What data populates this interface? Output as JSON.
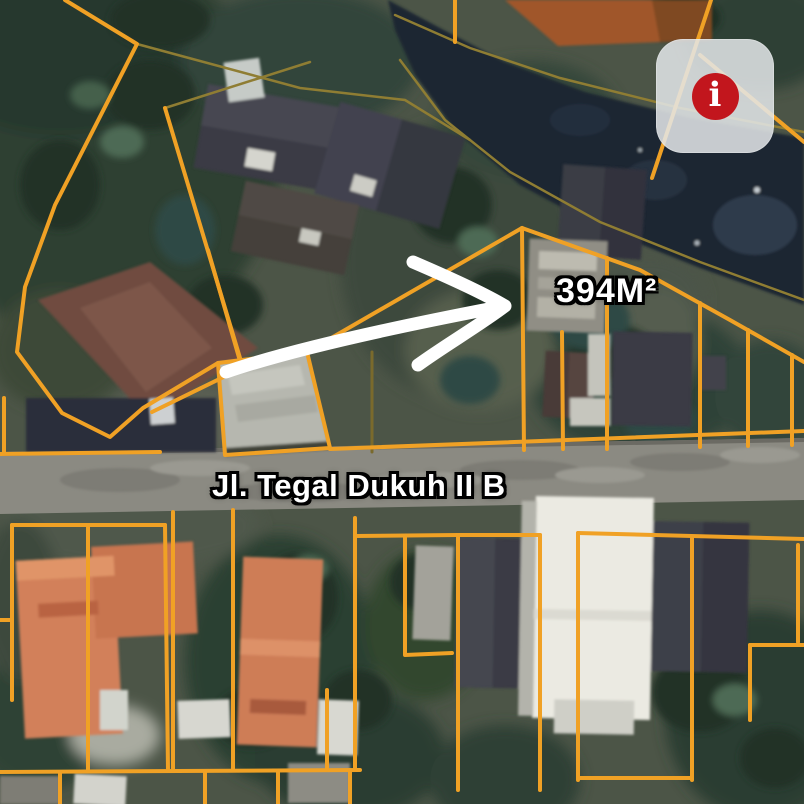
{
  "labels": {
    "area_size": "394M²",
    "road_name": "Jl. Tegal Dukuh II B"
  },
  "info_button": {
    "icon_name": "info-icon",
    "glyph": "i"
  },
  "colors": {
    "parcel_line": "#F0A125",
    "bank_line": "#8F7D33",
    "arrow": "#FFFFFF",
    "label_text": "#FFFFFF",
    "label_outline": "#000000",
    "info_badge_red": "#C2161D",
    "info_button_bg": "rgba(227,230,233,0.86)",
    "river": "#1D2532",
    "road": "#8B8A82"
  }
}
